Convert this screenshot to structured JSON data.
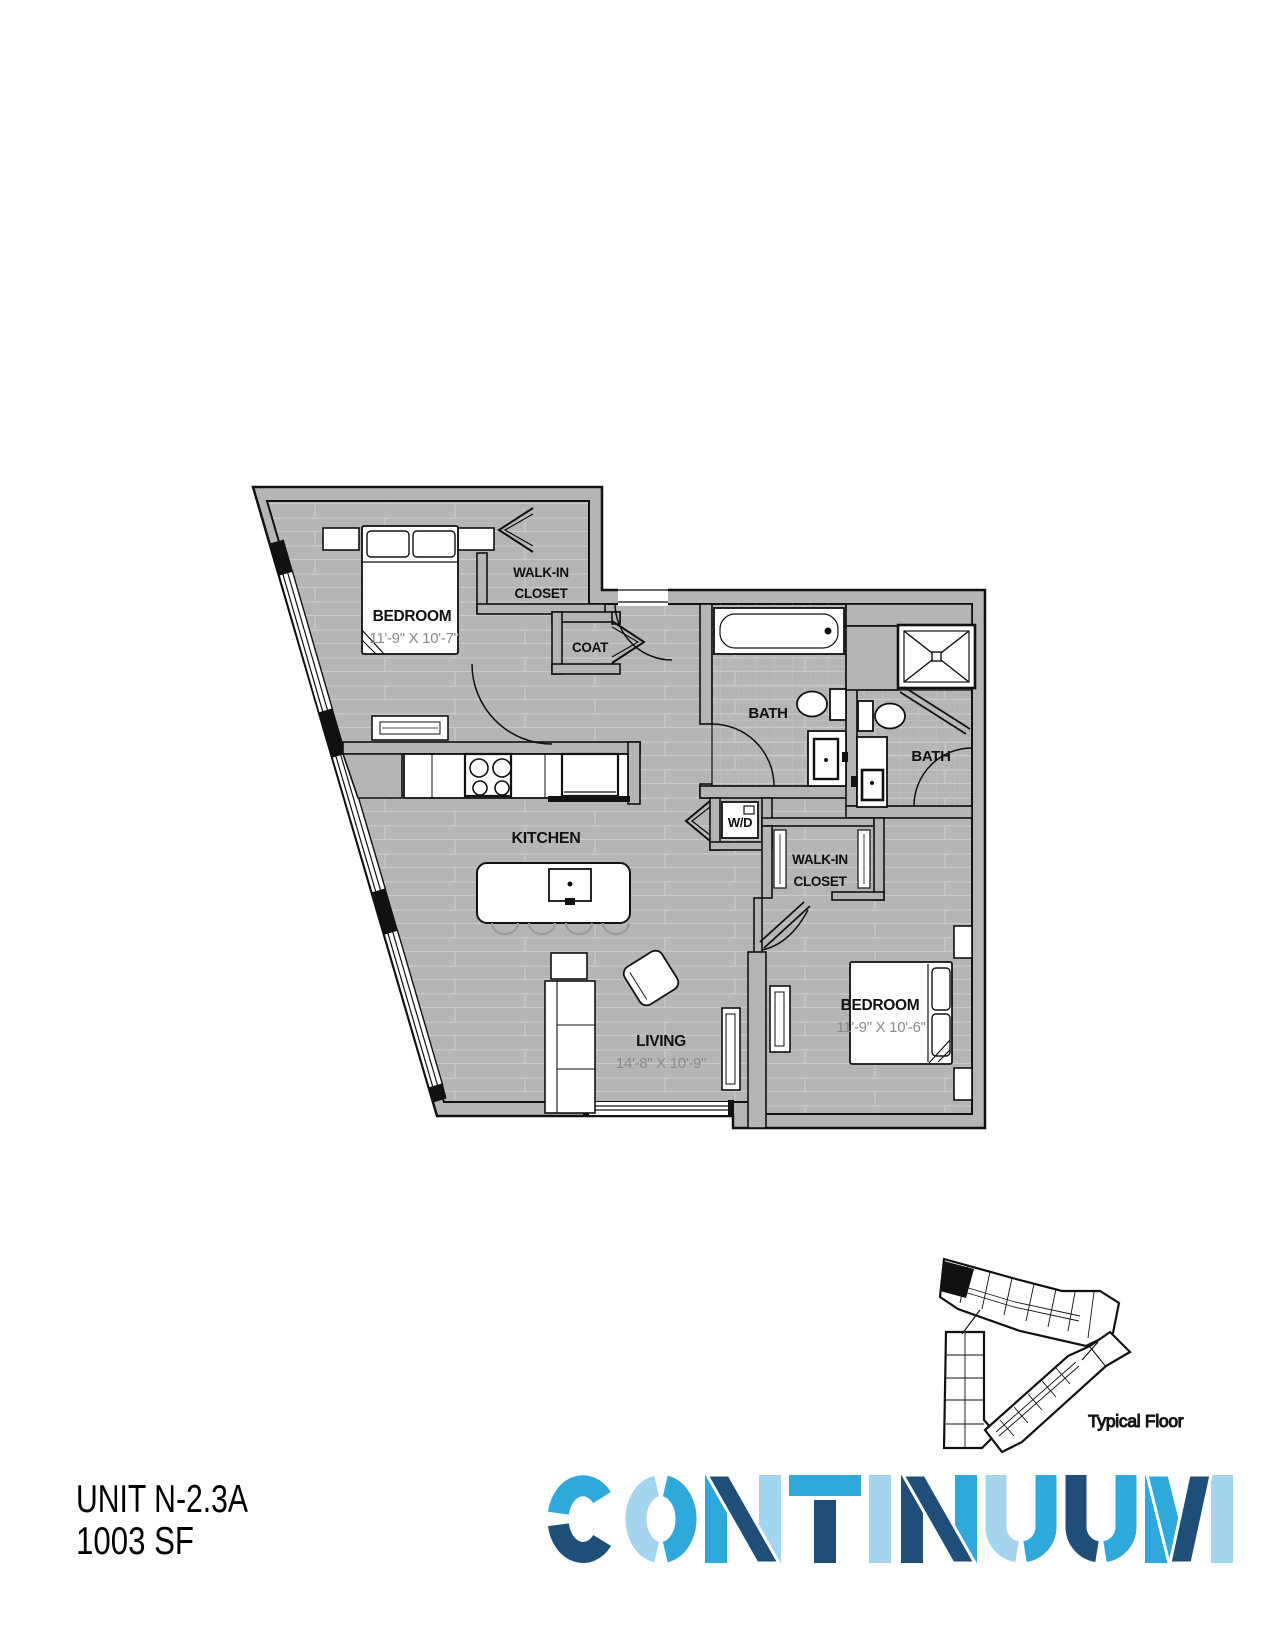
{
  "unit": {
    "name": "UNIT N-2.3A",
    "area": "1003 SF"
  },
  "floorplan": {
    "bedroom1": {
      "label": "BEDROOM",
      "dims": "11'-9\" X 10'-7\""
    },
    "walk_in_closet_1": {
      "line1": "WALK-IN",
      "line2": "CLOSET"
    },
    "coat": {
      "label": "COAT"
    },
    "bath1": {
      "label": "BATH"
    },
    "bath2": {
      "label": "BATH"
    },
    "laundry": {
      "label": "W/D"
    },
    "walk_in_closet_2": {
      "line1": "WALK-IN",
      "line2": "CLOSET"
    },
    "kitchen": {
      "label": "KITCHEN"
    },
    "living": {
      "label": "LIVING",
      "dims": "14'-8\" X 10'-9\""
    },
    "bedroom2": {
      "label": "BEDROOM",
      "dims": "11'-9\" X 10'-6\""
    }
  },
  "keyplan": {
    "caption": "Typical Floor"
  },
  "logo": {
    "text": "CONTINUUM",
    "colors": {
      "cyan": "#2FA8DB",
      "navy": "#1F4E79",
      "pale": "#A5D5EE"
    }
  }
}
